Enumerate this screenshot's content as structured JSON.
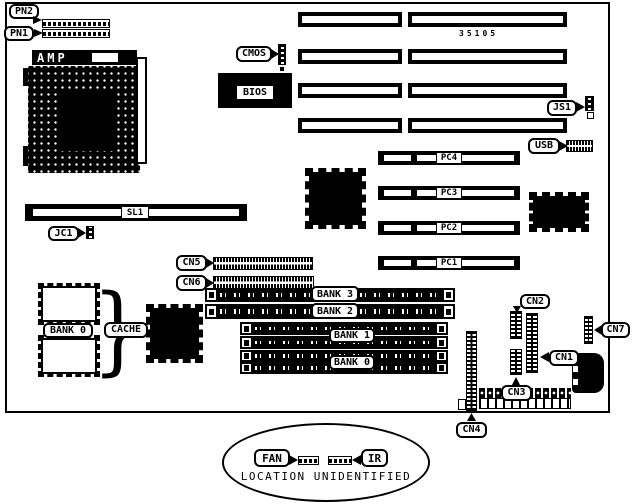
{
  "colors": {
    "ink": "#000000",
    "paper": "#ffffff"
  },
  "board": {
    "id_text": "35105"
  },
  "cpu_socket": {
    "label": "AMP"
  },
  "bios": {
    "label": "BIOS"
  },
  "callouts": {
    "pn2": "PN2",
    "pn1": "PN1",
    "cmos": "CMOS",
    "js1": "JS1",
    "usb": "USB",
    "jc1": "JC1",
    "cn5": "CN5",
    "cn6": "CN6",
    "cn2": "CN2",
    "cn1": "CN1",
    "cn3": "CN3",
    "cn4": "CN4",
    "cn7": "CN7",
    "fan": "FAN",
    "ir": "IR",
    "cache": "CACHE",
    "cache_bank": "BANK 0"
  },
  "slots": {
    "sl1": "SL1",
    "pci": [
      "PC4",
      "PC3",
      "PC2",
      "PC1"
    ],
    "memory_banks": [
      "BANK 3",
      "BANK 2",
      "BANK 1",
      "BANK 0"
    ]
  },
  "footer": {
    "note": "LOCATION UNIDENTIFIED"
  }
}
